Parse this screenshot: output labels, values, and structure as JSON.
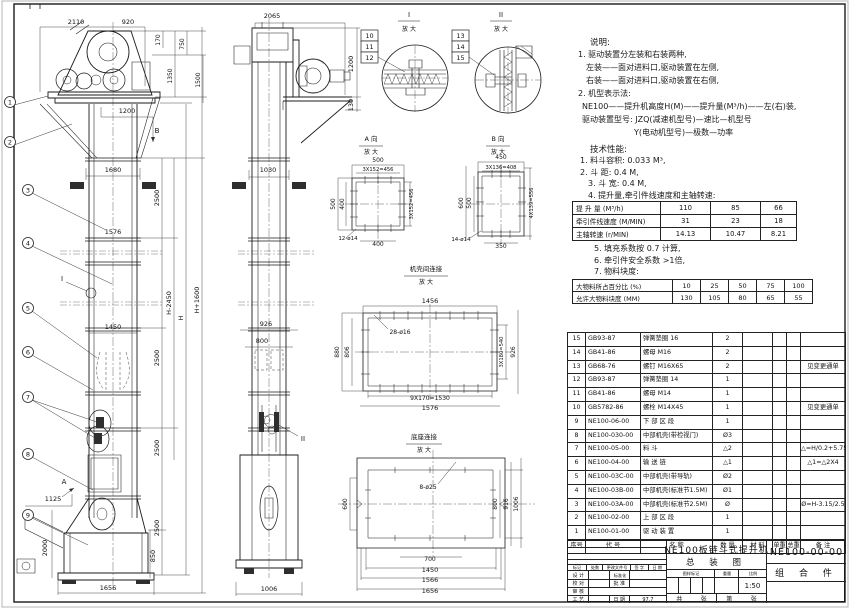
{
  "notes": {
    "heading": "说明:",
    "items": [
      {
        "t": "1. 驱动装置分左装和右装两种,",
        "ind": 6
      },
      {
        "t": "左装——面对进料口,驱动装置在左侧,",
        "ind": 14
      },
      {
        "t": "右装——面对进料口,驱动装置在右侧,",
        "ind": 14
      },
      {
        "t": "2. 机型表示法:",
        "ind": 6
      },
      {
        "t": "NE100——提升机高度H(M)——提升量(M³/h)——左(右)装,",
        "ind": 10
      },
      {
        "t": "驱动装置型号: JZQ(减速机型号)—速比—机型号",
        "ind": 10
      },
      {
        "t": "Y(电动机型号)—极数—功率",
        "ind": 62
      }
    ]
  },
  "specs": {
    "heading": "技术性能:",
    "items_before": [
      {
        "t": "1. 料斗容积: 0.033 M³,",
        "ind": 8
      },
      {
        "t": "2. 斗  距: 0.4 M,",
        "ind": 8
      },
      {
        "t": "3. 斗  宽: 0.4 M,",
        "ind": 16
      },
      {
        "t": "4. 提升量,牵引件线速度和主轴转速:",
        "ind": 16
      }
    ],
    "items_after": [
      {
        "t": "5. 填充系数按 0.7 计算,",
        "ind": 22
      },
      {
        "t": "6. 牵引件安全系数 >1倍,",
        "ind": 22
      },
      {
        "t": "7. 物料块度:",
        "ind": 22
      }
    ],
    "perf_table": {
      "rows": [
        {
          "label": "提 升 量",
          "unit": "(M³/h)",
          "values": [
            "110",
            "85",
            "66"
          ]
        },
        {
          "label": "牵引件线速度",
          "unit": "(M/MIN)",
          "values": [
            "31",
            "23",
            "18"
          ]
        },
        {
          "label": "主轴转速",
          "unit": "(r/MIN)",
          "values": [
            "14.13",
            "10.47",
            "8.21"
          ]
        }
      ]
    },
    "size_table": {
      "rows": [
        {
          "label": "大物料所占百分比",
          "unit": "(%)",
          "values": [
            "10",
            "25",
            "50",
            "75",
            "100"
          ]
        },
        {
          "label": "允许大物料块度",
          "unit": "(MM)",
          "values": [
            "130",
            "105",
            "80",
            "65",
            "55"
          ]
        }
      ]
    }
  },
  "bom": {
    "headers": [
      "序号",
      "代  号",
      "名  称",
      "数 量",
      "材  料",
      "单重",
      "总重",
      "备 注"
    ],
    "rows": [
      [
        "15",
        "GB93-87",
        "弹簧垫圈  16",
        "2",
        "",
        "",
        "",
        ""
      ],
      [
        "14",
        "GB41-86",
        "螺母  M16",
        "2",
        "",
        "",
        "",
        ""
      ],
      [
        "13",
        "GB68-76",
        "螺钉  M16X65",
        "2",
        "",
        "",
        "",
        "见变更通单"
      ],
      [
        "12",
        "GB93-87",
        "弹簧垫圈  14",
        "1",
        "",
        "",
        "",
        ""
      ],
      [
        "11",
        "GB41-86",
        "螺母  M14",
        "1",
        "",
        "",
        "",
        ""
      ],
      [
        "10",
        "GB5782-86",
        "螺栓  M14X45",
        "1",
        "",
        "",
        "",
        "见变更通单"
      ],
      [
        "9",
        "NE100-06-00",
        "下 部 区 段",
        "1",
        "",
        "",
        "",
        ""
      ],
      [
        "8",
        "NE100-030-00",
        "中部机壳(带检视门)",
        "Ø3",
        "",
        "",
        "",
        ""
      ],
      [
        "7",
        "NE100-05-00",
        "料  斗",
        "△2",
        "",
        "",
        "",
        "△=H/0.2+5.75"
      ],
      [
        "6",
        "NE100-04-00",
        "输 送 链",
        "△1",
        "",
        "",
        "",
        "△1=△2X4"
      ],
      [
        "5",
        "NE100-03C-00",
        "中部机壳(带导轨)",
        "Ø2",
        "",
        "",
        "",
        ""
      ],
      [
        "4",
        "NE100-03B-00",
        "中部机壳(标准节1.5M)",
        "Ø1",
        "",
        "",
        "",
        ""
      ],
      [
        "3",
        "NE100-03A-00",
        "中部机壳(标准节2.5M)",
        "Ø",
        "",
        "",
        "",
        "Ø=H-3.15/2.5"
      ],
      [
        "2",
        "NE100-02-00",
        "上 部 区 段",
        "1",
        "",
        "",
        "",
        ""
      ],
      [
        "1",
        "NE100-01-00",
        "驱 动 装 置",
        "1",
        "",
        "",
        "",
        ""
      ]
    ]
  },
  "titleblock": {
    "rev_cols": [
      "标记",
      "处数",
      "更改文件号",
      "签 字",
      "日 期"
    ],
    "design": "设 计",
    "std": "标准化",
    "check": "校 对",
    "approve": "批 准",
    "audit": "审 核",
    "process": "工 艺",
    "date_label": "日 期",
    "date_value": "97.7",
    "stamp": "图样标记",
    "weight": "重量",
    "scale_label": "比例",
    "scale": "1:50",
    "total_label": "共",
    "sheet_label": "张",
    "page_label": "第",
    "page_label2": "张",
    "title1": "NE100板链斗式提升机",
    "title2": "总 装 图",
    "dwg_no": "NE100-00-00",
    "part_class": "组 合 件"
  },
  "drawing": {
    "labels": [
      {
        "t": "2110",
        "x": 76,
        "y": 24
      },
      {
        "t": "920",
        "x": 128,
        "y": 24
      },
      {
        "t": "170",
        "x": 160,
        "y": 40,
        "r": -90,
        "s": 6
      },
      {
        "t": "1350",
        "x": 172,
        "y": 76,
        "r": -90,
        "s": 6
      },
      {
        "t": "750",
        "x": 184,
        "y": 44,
        "r": -90,
        "s": 6
      },
      {
        "t": "1500",
        "x": 200,
        "y": 80,
        "r": -90,
        "s": 6
      },
      {
        "t": "1200",
        "x": 127,
        "y": 113,
        "s": 6.5
      },
      {
        "t": "B",
        "x": 157,
        "y": 133,
        "s": 7,
        "n": "view-b-marker"
      },
      {
        "t": "1680",
        "x": 113,
        "y": 172,
        "s": 6.5
      },
      {
        "t": "1576",
        "x": 113,
        "y": 234,
        "s": 6.5
      },
      {
        "t": "1450",
        "x": 113,
        "y": 329,
        "s": 6.5
      },
      {
        "t": "2500",
        "x": 159,
        "y": 198,
        "r": -90,
        "s": 6.5
      },
      {
        "t": "2500",
        "x": 159,
        "y": 358,
        "r": -90,
        "s": 6.5
      },
      {
        "t": "2500",
        "x": 159,
        "y": 448,
        "r": -90,
        "s": 6.5
      },
      {
        "t": "2500",
        "x": 159,
        "y": 528,
        "r": -90,
        "s": 6.5
      },
      {
        "t": "H-2450",
        "x": 171,
        "y": 303,
        "r": -90,
        "s": 6.5
      },
      {
        "t": "H",
        "x": 183,
        "y": 318,
        "r": -90,
        "s": 6.5
      },
      {
        "t": "H+1600",
        "x": 199,
        "y": 300,
        "r": -90,
        "s": 6.5
      },
      {
        "t": "I",
        "x": 62,
        "y": 281,
        "s": 7,
        "n": "detail-i-marker"
      },
      {
        "t": "A",
        "x": 64,
        "y": 484,
        "s": 7,
        "n": "section-a-marker"
      },
      {
        "t": "1125",
        "x": 53,
        "y": 501,
        "s": 6.5
      },
      {
        "t": "2000",
        "x": 47,
        "y": 548,
        "r": -90,
        "s": 6.5
      },
      {
        "t": "850",
        "x": 155,
        "y": 556,
        "r": -90,
        "s": 6.5
      },
      {
        "t": "1656",
        "x": 108,
        "y": 590,
        "s": 6.5
      },
      {
        "t": "2065",
        "x": 272,
        "y": 18
      },
      {
        "t": "1030",
        "x": 268,
        "y": 172,
        "s": 6.5
      },
      {
        "t": "1200",
        "x": 353,
        "y": 64,
        "r": -90,
        "s": 6.5
      },
      {
        "t": "130",
        "x": 353,
        "y": 105,
        "r": -90,
        "s": 6.5
      },
      {
        "t": "926",
        "x": 266,
        "y": 326,
        "s": 6.5
      },
      {
        "t": "800",
        "x": 262,
        "y": 343,
        "s": 6.5
      },
      {
        "t": "1006",
        "x": 269,
        "y": 591,
        "s": 6.5
      },
      {
        "t": "II",
        "x": 303,
        "y": 441,
        "s": 7,
        "n": "detail-ii-marker"
      },
      {
        "t": "I",
        "x": 409,
        "y": 17,
        "s": 7,
        "n": "detail-title"
      },
      {
        "t": "放 大",
        "x": 409,
        "y": 31,
        "s": 6,
        "n": "detail-title"
      },
      {
        "t": "II",
        "x": 501,
        "y": 17,
        "s": 7,
        "n": "detail-title"
      },
      {
        "t": "放 大",
        "x": 501,
        "y": 31,
        "s": 6,
        "n": "detail-title"
      },
      {
        "t": "A 向",
        "x": 371,
        "y": 141,
        "s": 6.5,
        "n": "detail-title"
      },
      {
        "t": "放 大",
        "x": 371,
        "y": 154,
        "s": 6,
        "n": "detail-title"
      },
      {
        "t": "B 向",
        "x": 498,
        "y": 141,
        "s": 6.5,
        "n": "detail-title"
      },
      {
        "t": "放 大",
        "x": 498,
        "y": 154,
        "s": 6,
        "n": "detail-title"
      },
      {
        "t": "机壳间连接",
        "x": 426,
        "y": 271,
        "s": 6.5,
        "n": "detail-title"
      },
      {
        "t": "放 大",
        "x": 426,
        "y": 284,
        "s": 6,
        "n": "detail-title"
      },
      {
        "t": "底座连接",
        "x": 424,
        "y": 439,
        "s": 6.5,
        "n": "detail-title"
      },
      {
        "t": "放 大",
        "x": 424,
        "y": 452,
        "s": 6,
        "n": "detail-title"
      },
      {
        "t": "500",
        "x": 378,
        "y": 162,
        "s": 6
      },
      {
        "t": "3X152=456",
        "x": 378,
        "y": 171,
        "s": 5.2
      },
      {
        "t": "500",
        "x": 335,
        "y": 204,
        "r": -90,
        "s": 6
      },
      {
        "t": "400",
        "x": 344,
        "y": 204,
        "r": -90,
        "s": 6
      },
      {
        "t": "3X152=456",
        "x": 413,
        "y": 204,
        "r": -90,
        "s": 5.2
      },
      {
        "t": "400",
        "x": 378,
        "y": 246,
        "s": 6
      },
      {
        "t": "12-ø14",
        "x": 348,
        "y": 240,
        "s": 5.5
      },
      {
        "t": "450",
        "x": 501,
        "y": 159,
        "s": 6
      },
      {
        "t": "3X136=408",
        "x": 501,
        "y": 169,
        "s": 5.2
      },
      {
        "t": "600",
        "x": 463,
        "y": 203,
        "r": -90,
        "s": 6
      },
      {
        "t": "500",
        "x": 471,
        "y": 203,
        "r": -90,
        "s": 6
      },
      {
        "t": "4X139=556",
        "x": 533,
        "y": 203,
        "r": -90,
        "s": 5.2
      },
      {
        "t": "350",
        "x": 501,
        "y": 248,
        "s": 6
      },
      {
        "t": "14-ø14",
        "x": 461,
        "y": 241,
        "s": 5.5
      },
      {
        "t": "1456",
        "x": 430,
        "y": 303,
        "s": 6.5
      },
      {
        "t": "28-ø16",
        "x": 400,
        "y": 334,
        "s": 6
      },
      {
        "t": "880",
        "x": 339,
        "y": 352,
        "r": -90,
        "s": 6
      },
      {
        "t": "806",
        "x": 349,
        "y": 352,
        "r": -90,
        "s": 6
      },
      {
        "t": "3X180=540",
        "x": 503,
        "y": 352,
        "r": -90,
        "s": 5.2
      },
      {
        "t": "926",
        "x": 515,
        "y": 352,
        "r": -90,
        "s": 6
      },
      {
        "t": "9X170=1530",
        "x": 430,
        "y": 400,
        "s": 6
      },
      {
        "t": "1576",
        "x": 430,
        "y": 410,
        "s": 6.5
      },
      {
        "t": "8-ø25",
        "x": 428,
        "y": 489,
        "s": 6
      },
      {
        "t": "600",
        "x": 347,
        "y": 504,
        "r": -90,
        "s": 6
      },
      {
        "t": "800",
        "x": 497,
        "y": 504,
        "r": -90,
        "s": 6
      },
      {
        "t": "916",
        "x": 508,
        "y": 504,
        "r": -90,
        "s": 6
      },
      {
        "t": "1006",
        "x": 518,
        "y": 504,
        "r": -90,
        "s": 6
      },
      {
        "t": "700",
        "x": 430,
        "y": 561,
        "s": 6
      },
      {
        "t": "1450",
        "x": 430,
        "y": 572,
        "s": 6.5
      },
      {
        "t": "1566",
        "x": 430,
        "y": 582,
        "s": 6.5
      },
      {
        "t": "1656",
        "x": 430,
        "y": 593,
        "s": 6.5
      }
    ],
    "balloons": [
      {
        "t": "1",
        "x": 10,
        "y": 102,
        "l": [
          [
            48,
            96
          ]
        ]
      },
      {
        "t": "2",
        "x": 10,
        "y": 142,
        "l": [
          [
            72,
            124
          ]
        ]
      },
      {
        "t": "3",
        "x": 28,
        "y": 190,
        "l": [
          [
            106,
            230
          ]
        ]
      },
      {
        "t": "4",
        "x": 28,
        "y": 243,
        "l": [
          [
            112,
            284
          ]
        ]
      },
      {
        "t": "5",
        "x": 28,
        "y": 308,
        "l": [
          [
            97,
            358
          ]
        ]
      },
      {
        "t": "6",
        "x": 28,
        "y": 352,
        "l": [
          [
            93,
            390
          ]
        ]
      },
      {
        "t": "7",
        "x": 28,
        "y": 397,
        "l": [
          [
            97,
            422
          ],
          [
            95,
            438
          ]
        ]
      },
      {
        "t": "8",
        "x": 28,
        "y": 454,
        "l": [
          [
            93,
            490
          ]
        ]
      },
      {
        "t": "9",
        "x": 28,
        "y": 515,
        "l": [
          [
            88,
            545
          ]
        ]
      }
    ],
    "boxed": [
      {
        "t": "10",
        "x": 361,
        "y": 30
      },
      {
        "t": "11",
        "x": 361,
        "y": 41
      },
      {
        "t": "12",
        "x": 361,
        "y": 52
      },
      {
        "t": "13",
        "x": 452,
        "y": 30
      },
      {
        "t": "14",
        "x": 452,
        "y": 41
      },
      {
        "t": "15",
        "x": 452,
        "y": 52
      }
    ]
  }
}
